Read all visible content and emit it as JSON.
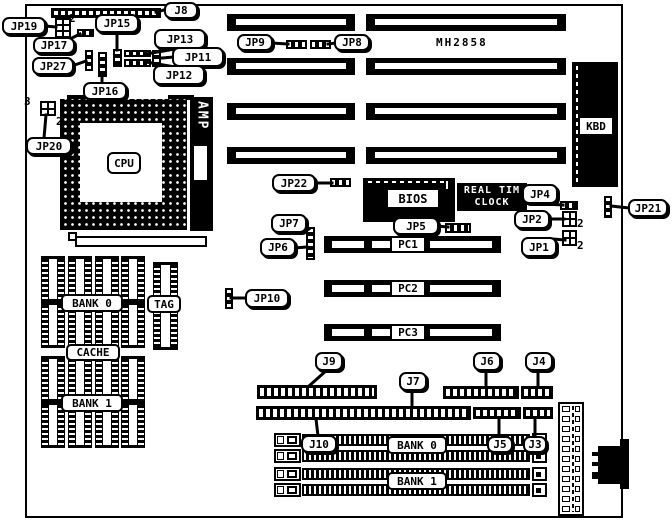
{
  "components": {
    "model": "MH2858",
    "cpu": "CPU",
    "amp": "AMP",
    "kbd": "KBD",
    "bios": "BIOS",
    "rtc_line1": "REAL TIM",
    "rtc_line2": "CLOCK"
  },
  "slots": {
    "pc1": "PC1",
    "pc2": "PC2",
    "pc3": "PC3"
  },
  "memory": {
    "cache_bank0": "BANK 0",
    "tag": "TAG",
    "cache": "CACHE",
    "cache_bank1": "BANK 1",
    "simm_bank0": "BANK 0",
    "simm_bank1": "BANK 1"
  },
  "callouts": {
    "j8": "J8",
    "jp19": "JP19",
    "jp15": "JP15",
    "jp13": "JP13",
    "jp11": "JP11",
    "jp12": "JP12",
    "jp17": "JP17",
    "jp27": "JP27",
    "jp16": "JP16",
    "jp20": "JP20",
    "jp9": "JP9",
    "jp8": "JP8",
    "jp22": "JP22",
    "jp7": "JP7",
    "jp6": "JP6",
    "jp10": "JP10",
    "jp5": "JP5",
    "jp4": "JP4",
    "jp2": "JP2",
    "jp1": "JP1",
    "jp21": "JP21",
    "j9": "J9",
    "j7": "J7",
    "j6": "J6",
    "j4": "J4",
    "j10": "J10",
    "j5": "J5",
    "j3": "J3"
  },
  "pins": {
    "jp19_2": "2",
    "jp20_3": "3",
    "jp20_2": "2",
    "jp2_2": "2",
    "jp1_2": "2"
  },
  "colors": {
    "ink": "#000000",
    "paper": "#ffffff"
  }
}
